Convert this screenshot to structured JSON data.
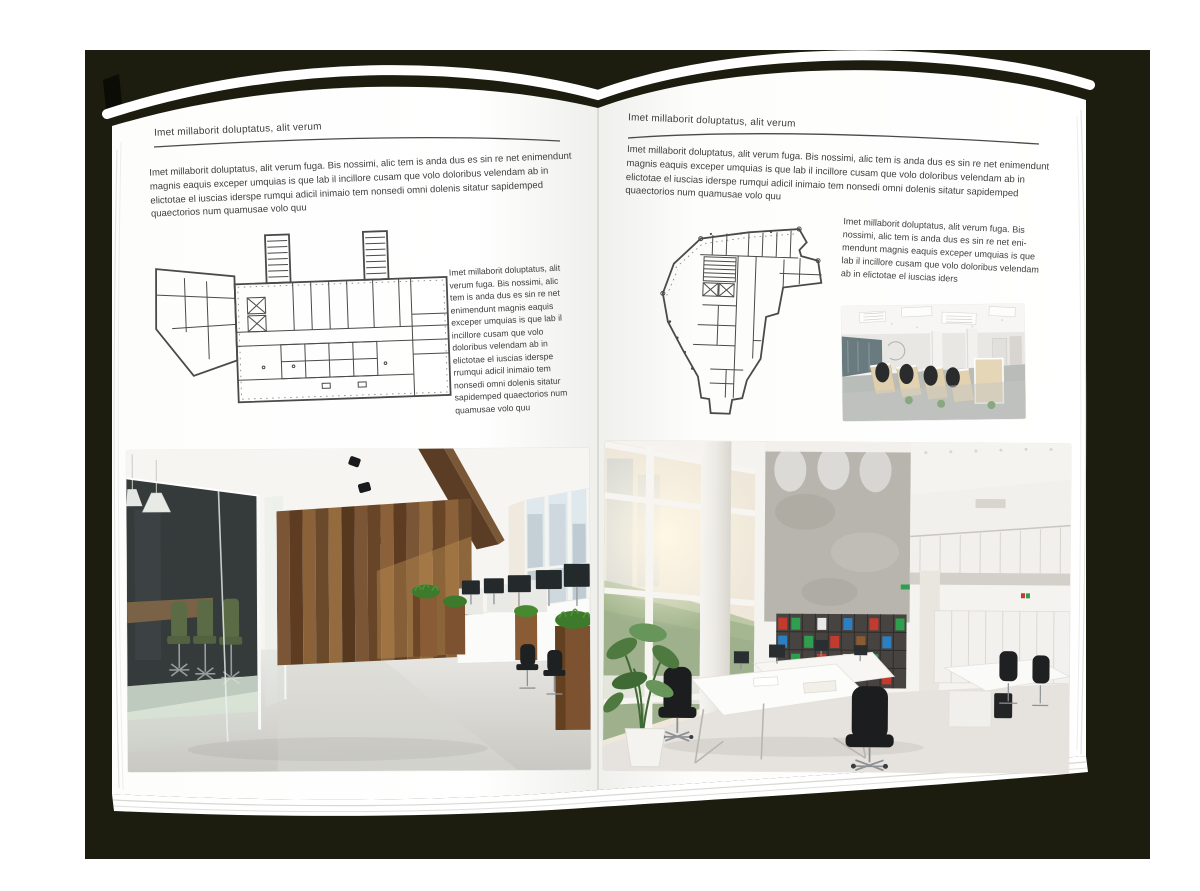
{
  "document": {
    "kind": "magazine-spread-mockup",
    "backdrop_color": "#1c1d0f",
    "page_color": "#ffffff",
    "text_color": "#3e3e3e"
  },
  "left_page": {
    "header": "Imet millaborit doluptatus, alit verum",
    "intro": "Imet millaborit doluptatus, alit verum fuga. Bis nossimi, alic tem is anda dus es sin re net enimendunt magnis eaquis exceper umquias is que lab il incillore cusam que volo doloribus velendam ab in elictotae el iuscias iderspe rumqui adicil inimaio tem nonsedi omni dolenis sitatur sapidemped quaectorios num quamusae volo quu",
    "sidebar": "Imet millaborit doluptatus, alit verum fuga. Bis nossimi, alic tem is anda dus es sin re net enimendunt magnis eaquis exceper umquias is que lab il incillore cusam que volo doloribus velendam ab in elictotae el iuscias iderspe rrumqui adicil inimaio tem nonsedi omni dolenis sitatur sapidemped quaectorios num quamusae volo quu",
    "floorplan": "wide-office-building-floor-plan",
    "photo": "loft-office-with-glass-meeting-room-and-wood-wall"
  },
  "right_page": {
    "header": "Imet millaborit doluptatus, alit verum",
    "intro": "Imet millaborit doluptatus, alit verum fuga. Bis nossimi, alic tem is anda dus es sin re net enimendunt magnis eaquis exceper umquias is que lab il incillore cusam que volo doloribus velendam ab in elictotae el iuscias iderspe rumqui adicil inimaio tem nonsedi omni dolenis sitatur sapidemped quaectorios num quamusae volo quu",
    "sidebar": "Imet millaborit doluptatus, alit verum fuga. Bis nossimi, alic tem is anda dus es sin re net eni-mendunt magnis eaquis exceper umquias is que lab il incillore cusam que volo doloribus velendam ab in elictotae el iuscias iders",
    "floorplan": "wedge-shaped-office-floor-plan",
    "photo_small": "open-plan-office-workstation-rows",
    "photo": "bright-double-height-office-with-bookshelf"
  },
  "palette": {
    "wood_dark": "#5d3c22",
    "wood_light": "#8a6138",
    "chair_green": "#46572e",
    "binder_red": "#c23b2e",
    "binder_green": "#2f9e4f",
    "binder_blue": "#2e7fc0",
    "plan_ink": "#4a4a4a"
  }
}
